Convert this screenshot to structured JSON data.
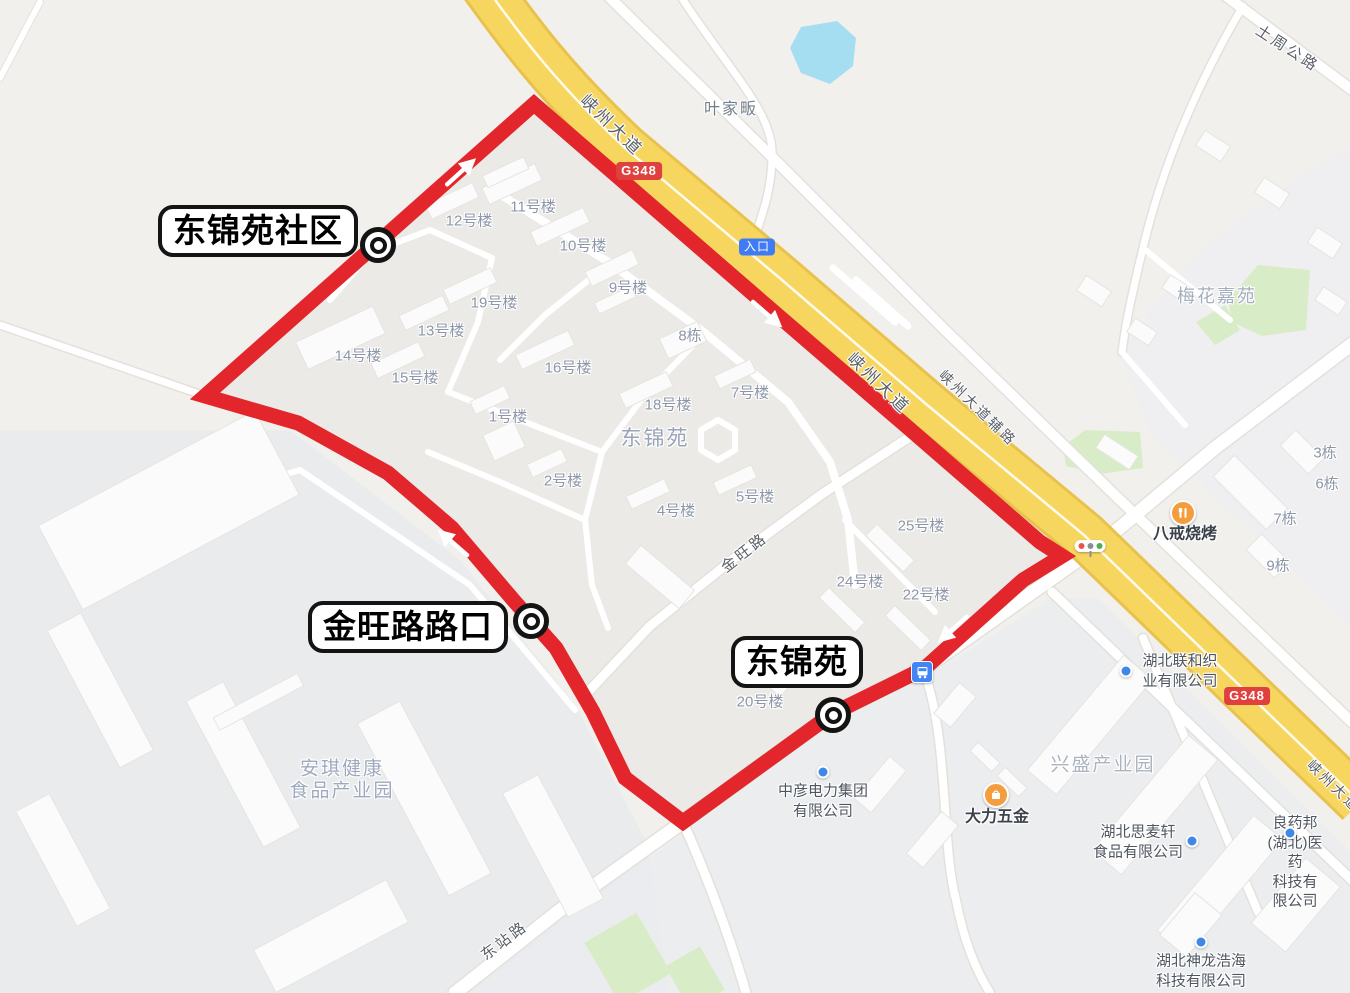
{
  "map": {
    "colors": {
      "route": "#E2262B",
      "highway_fill": "#F7D65F",
      "water": "#A5DEF0",
      "green": "#D8ECC8",
      "road_badge": "#E0413E",
      "entrance_badge": "#3F7BF5",
      "poi_orange": "#F49D3D",
      "poi_dot": "#3F88E8"
    },
    "stops": [
      {
        "label": "东锦苑社区",
        "box": {
          "x": 158,
          "y": 205
        },
        "marker": {
          "x": 378,
          "y": 245
        }
      },
      {
        "label": "金旺路路口",
        "box": {
          "x": 308,
          "y": 601
        },
        "marker": {
          "x": 531,
          "y": 621
        }
      },
      {
        "label": "东锦苑",
        "box": {
          "x": 731,
          "y": 636
        },
        "marker": {
          "x": 833,
          "y": 715
        }
      }
    ],
    "road_labels": [
      {
        "text": "峡州大道",
        "x": 613,
        "y": 124,
        "rot": 44,
        "size": 17
      },
      {
        "text": "峡州大道",
        "x": 880,
        "y": 382,
        "rot": 44,
        "size": 17
      },
      {
        "text": "峡州大道辅路",
        "x": 978,
        "y": 408,
        "rot": 44,
        "size": 14
      },
      {
        "text": "峡州大道",
        "x": 1334,
        "y": 786,
        "rot": 44,
        "size": 14
      },
      {
        "text": "金旺路",
        "x": 744,
        "y": 552,
        "rot": -38,
        "size": 15
      },
      {
        "text": "东站路",
        "x": 504,
        "y": 940,
        "rot": -37,
        "size": 15
      },
      {
        "text": "土周公路",
        "x": 1288,
        "y": 48,
        "rot": 33,
        "size": 15
      }
    ],
    "area_labels": [
      {
        "text": "东锦苑",
        "x": 655,
        "y": 437,
        "size": 21,
        "color": "#98A3B8"
      },
      {
        "text": "梅花嘉苑",
        "x": 1217,
        "y": 295,
        "size": 18,
        "color": "#A5AEBE"
      },
      {
        "text": "兴盛产业园",
        "x": 1103,
        "y": 763,
        "size": 19,
        "color": "#ABB3BF"
      },
      {
        "text": "安琪健康",
        "x": 342,
        "y": 767,
        "size": 19,
        "color": "#9EA8BE"
      },
      {
        "text": "食品产业园",
        "x": 342,
        "y": 789,
        "size": 19,
        "color": "#9EA8BE"
      },
      {
        "text": "叶家畈",
        "x": 731,
        "y": 107,
        "size": 16,
        "color": "#73808C"
      }
    ],
    "building_labels": [
      {
        "text": "11号楼",
        "x": 533,
        "y": 206
      },
      {
        "text": "12号楼",
        "x": 469,
        "y": 220
      },
      {
        "text": "10号楼",
        "x": 583,
        "y": 245
      },
      {
        "text": "9号楼",
        "x": 628,
        "y": 287
      },
      {
        "text": "19号楼",
        "x": 494,
        "y": 302
      },
      {
        "text": "13号楼",
        "x": 441,
        "y": 330
      },
      {
        "text": "14号楼",
        "x": 358,
        "y": 355
      },
      {
        "text": "15号楼",
        "x": 415,
        "y": 377
      },
      {
        "text": "16号楼",
        "x": 568,
        "y": 367
      },
      {
        "text": "8栋",
        "x": 690,
        "y": 335
      },
      {
        "text": "18号楼",
        "x": 668,
        "y": 404
      },
      {
        "text": "7号楼",
        "x": 750,
        "y": 392
      },
      {
        "text": "1号楼",
        "x": 508,
        "y": 416
      },
      {
        "text": "2号楼",
        "x": 563,
        "y": 480
      },
      {
        "text": "4号楼",
        "x": 676,
        "y": 510
      },
      {
        "text": "5号楼",
        "x": 755,
        "y": 496
      },
      {
        "text": "25号楼",
        "x": 921,
        "y": 525
      },
      {
        "text": "24号楼",
        "x": 860,
        "y": 581
      },
      {
        "text": "22号楼",
        "x": 926,
        "y": 594
      },
      {
        "text": "20号楼",
        "x": 760,
        "y": 701
      },
      {
        "text": "3栋",
        "x": 1325,
        "y": 452
      },
      {
        "text": "6栋",
        "x": 1327,
        "y": 483
      },
      {
        "text": "7栋",
        "x": 1285,
        "y": 518
      },
      {
        "text": "9栋",
        "x": 1278,
        "y": 565
      }
    ],
    "poi_labels": [
      {
        "text": "湖北联和织\n业有限公司",
        "x": 1180,
        "y": 671,
        "dot": {
          "x": 1126,
          "y": 671
        }
      },
      {
        "text": "湖北思麦轩\n食品有限公司",
        "x": 1138,
        "y": 842,
        "dot": {
          "x": 1192,
          "y": 841
        }
      },
      {
        "text": "良药邦(湖北)医药\n科技有限公司",
        "x": 1295,
        "y": 862,
        "dot": {
          "x": 1290,
          "y": 833
        }
      },
      {
        "text": "湖北神龙浩海\n科技有限公司",
        "x": 1201,
        "y": 971,
        "dot": {
          "x": 1201,
          "y": 942
        }
      },
      {
        "text": "中彦电力集团\n有限公司",
        "x": 823,
        "y": 801,
        "dot": {
          "x": 823,
          "y": 772
        }
      },
      {
        "text": "八戒烧烤",
        "x": 1185,
        "y": 535,
        "big": true,
        "icon": "restaurant",
        "ix": 1183,
        "iy": 513
      },
      {
        "text": "大力五金",
        "x": 997,
        "y": 818,
        "big": true,
        "icon": "shopping",
        "ix": 996,
        "iy": 795
      }
    ],
    "badges": [
      {
        "text": "G348",
        "kind": "road",
        "x": 639,
        "y": 171
      },
      {
        "text": "G348",
        "kind": "road",
        "x": 1247,
        "y": 696
      },
      {
        "text": "入口",
        "kind": "entrance",
        "x": 757,
        "y": 247
      }
    ],
    "icons": {
      "bus_stop": {
        "x": 922,
        "y": 672
      },
      "traffic_light": {
        "x": 1090,
        "y": 546
      }
    }
  }
}
